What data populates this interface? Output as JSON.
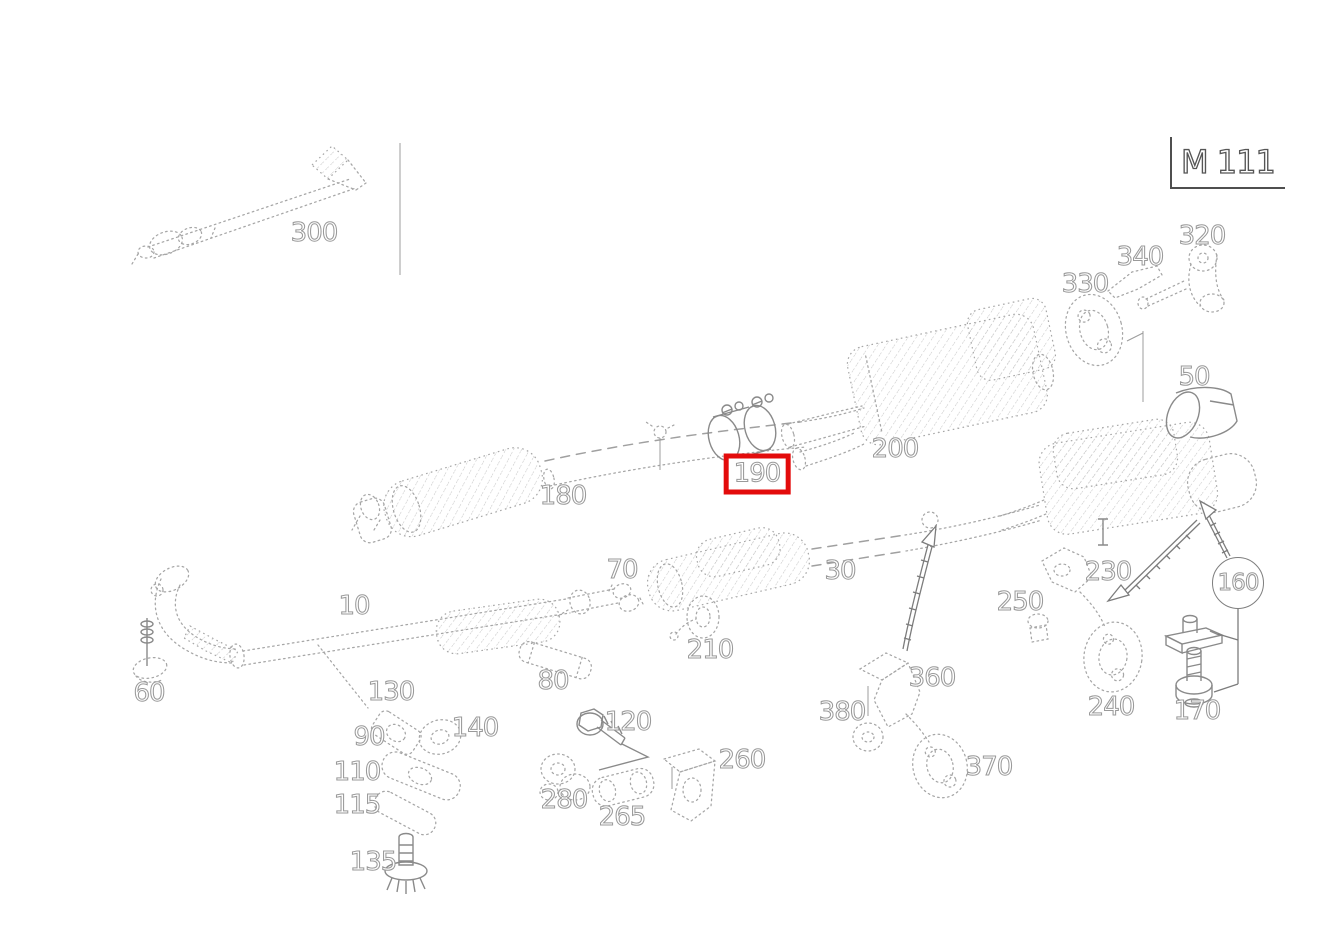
{
  "diagram": {
    "model_code": "M 111",
    "selected_part": "190",
    "highlight_color": "#e30b0b",
    "line_color": "#a6a6a6",
    "circled_part": "160"
  },
  "parts": [
    {
      "num": "300",
      "x": 314,
      "y": 233
    },
    {
      "num": "320",
      "x": 1202,
      "y": 236
    },
    {
      "num": "340",
      "x": 1140,
      "y": 257
    },
    {
      "num": "330",
      "x": 1085,
      "y": 284
    },
    {
      "num": "50",
      "x": 1194,
      "y": 377
    },
    {
      "num": "200",
      "x": 895,
      "y": 449
    },
    {
      "num": "190",
      "x": 757,
      "y": 474,
      "highlight": true
    },
    {
      "num": "180",
      "x": 563,
      "y": 496
    },
    {
      "num": "70",
      "x": 622,
      "y": 570
    },
    {
      "num": "30",
      "x": 840,
      "y": 571
    },
    {
      "num": "230",
      "x": 1108,
      "y": 572
    },
    {
      "num": "160",
      "x": 1238,
      "y": 583,
      "circle": true
    },
    {
      "num": "250",
      "x": 1020,
      "y": 602
    },
    {
      "num": "10",
      "x": 354,
      "y": 606
    },
    {
      "num": "210",
      "x": 710,
      "y": 650
    },
    {
      "num": "360",
      "x": 932,
      "y": 678
    },
    {
      "num": "80",
      "x": 553,
      "y": 681
    },
    {
      "num": "60",
      "x": 149,
      "y": 693
    },
    {
      "num": "130",
      "x": 391,
      "y": 692
    },
    {
      "num": "240",
      "x": 1111,
      "y": 707
    },
    {
      "num": "170",
      "x": 1197,
      "y": 711
    },
    {
      "num": "380",
      "x": 842,
      "y": 712
    },
    {
      "num": "120",
      "x": 628,
      "y": 722
    },
    {
      "num": "140",
      "x": 475,
      "y": 728
    },
    {
      "num": "90",
      "x": 369,
      "y": 737
    },
    {
      "num": "260",
      "x": 742,
      "y": 760
    },
    {
      "num": "370",
      "x": 989,
      "y": 767
    },
    {
      "num": "110",
      "x": 357,
      "y": 772
    },
    {
      "num": "280",
      "x": 564,
      "y": 800
    },
    {
      "num": "115",
      "x": 357,
      "y": 805
    },
    {
      "num": "265",
      "x": 622,
      "y": 817
    },
    {
      "num": "135",
      "x": 373,
      "y": 862
    }
  ]
}
